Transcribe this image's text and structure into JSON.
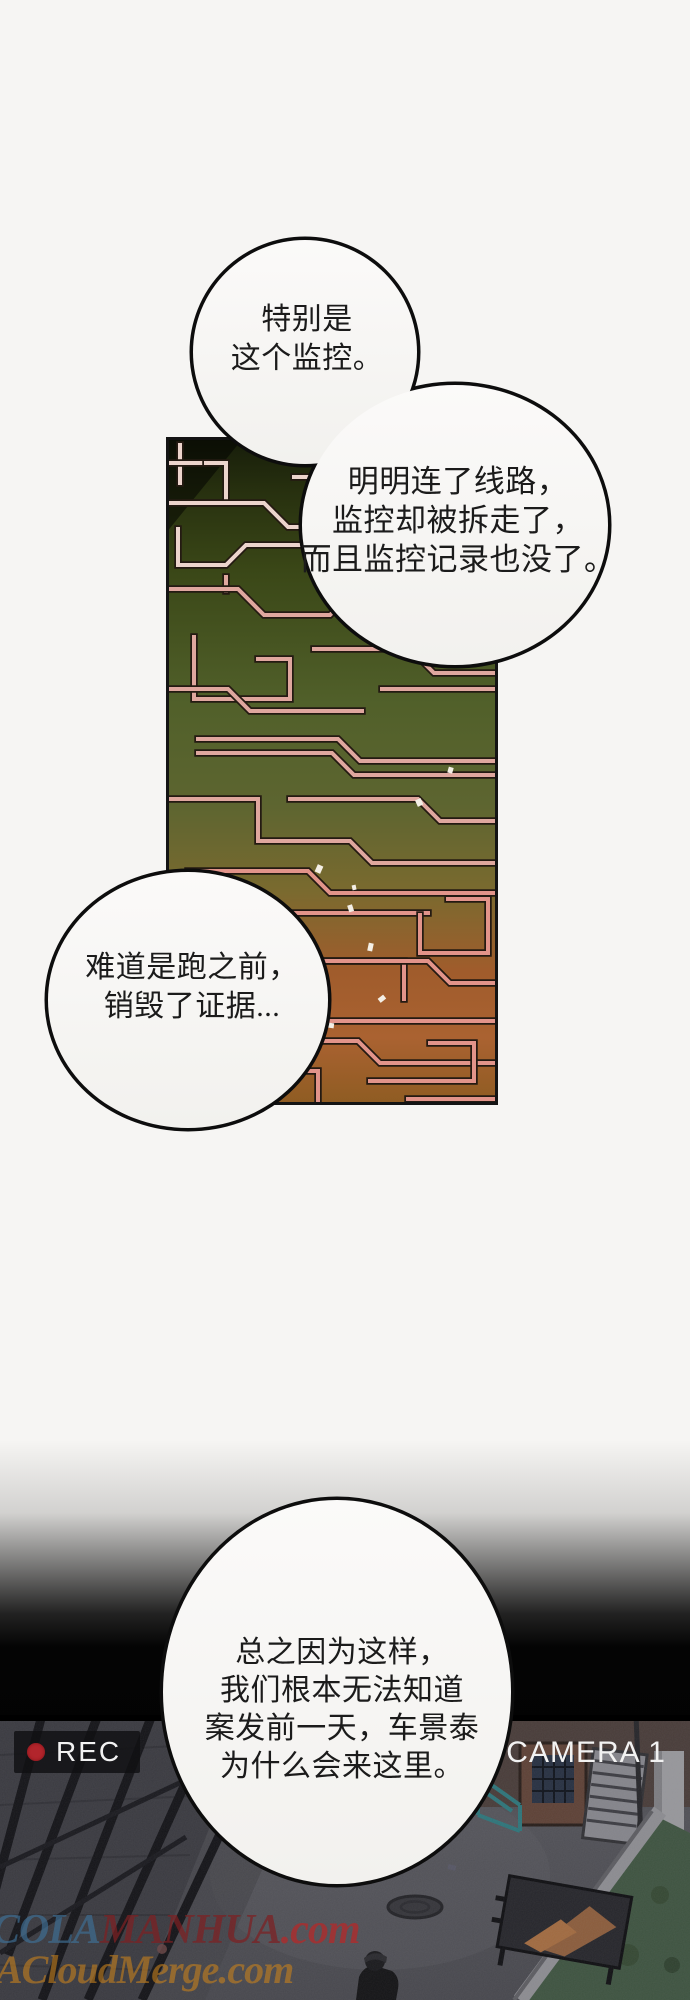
{
  "panel": {
    "type": "webtoon-comic-panel",
    "background_color": "#f6f5f3"
  },
  "speech_bubbles": {
    "bubble1": {
      "line1": "特别是",
      "line2": "这个监控。"
    },
    "bubble2": {
      "line1": "明明连了线路，",
      "line2": "监控却被拆走了，",
      "line3": "而且监控记录也没了。"
    },
    "bubble3": {
      "line1": "难道是跑之前，",
      "line2": "销毁了证据..."
    },
    "bubble4": {
      "line1": "总之因为这样，",
      "line2": "我们根本无法知道",
      "line3": "案发前一天，车景泰",
      "line4": "为什么会来这里。"
    }
  },
  "cctv_overlay": {
    "rec_label": "REC",
    "camera_label": "CAMERA 1",
    "rec_dot_color": "#b2252c",
    "label_text_color": "#f2f2f2",
    "badge_background": "rgba(16,16,18,0.82)"
  },
  "watermarks": {
    "site1_prefix": "COLA",
    "site1_name": "MANHUA",
    "site1_suffix": ".com",
    "site2": "ACloudMerge.com"
  },
  "artwork_colors": {
    "maze_top_green": "#2b3413",
    "maze_mid_green": "#53612a",
    "maze_bottom_orange": "#a85f2d",
    "maze_trace_pink": "#dfa79e",
    "scene_base_gray": "#4a4a50",
    "scene_grass_green": "#3e5340",
    "bubble_fill": "#f8f7f5",
    "bubble_outline": "#0d0d0d"
  }
}
